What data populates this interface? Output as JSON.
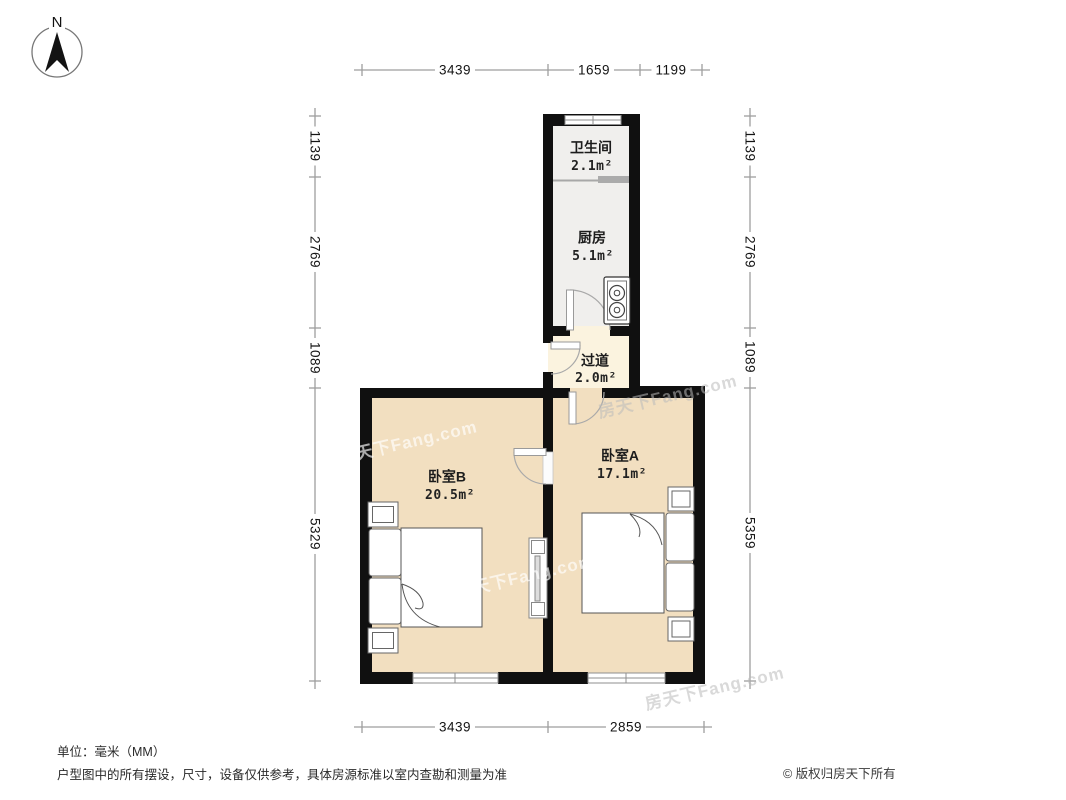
{
  "compass": {
    "north_label": "N"
  },
  "rooms": {
    "bathroom": {
      "name": "卫生间",
      "area": "2.1m²"
    },
    "kitchen": {
      "name": "厨房",
      "area": "5.1m²"
    },
    "hallway": {
      "name": "过道",
      "area": "2.0m²"
    },
    "bedroom_b": {
      "name": "卧室B",
      "area": "20.5m²"
    },
    "bedroom_a": {
      "name": "卧室A",
      "area": "17.1m²"
    }
  },
  "dimensions": {
    "unit": "mm",
    "top": [
      "3439",
      "1659",
      "1199"
    ],
    "bottom": [
      "3439",
      "2859"
    ],
    "left": [
      "1139",
      "2769",
      "1089",
      "5329"
    ],
    "right": [
      "1139",
      "2769",
      "1089",
      "5359"
    ]
  },
  "watermark": "房天下Fang.com",
  "footer": {
    "unit_note": "单位：毫米（MM）",
    "disclaimer": "户型图中的所有摆设，尺寸，设备仅供参考，具体房源标准以室内查勘和测量为准",
    "copyright": "© 版权归房天下所有"
  },
  "colors": {
    "wall": "#101010",
    "bedroom_floor": "#f2dfc0",
    "hallway_floor": "#fbf3df",
    "kitchen_floor": "#f0efed",
    "dimension_line": "#9e9e9e"
  }
}
